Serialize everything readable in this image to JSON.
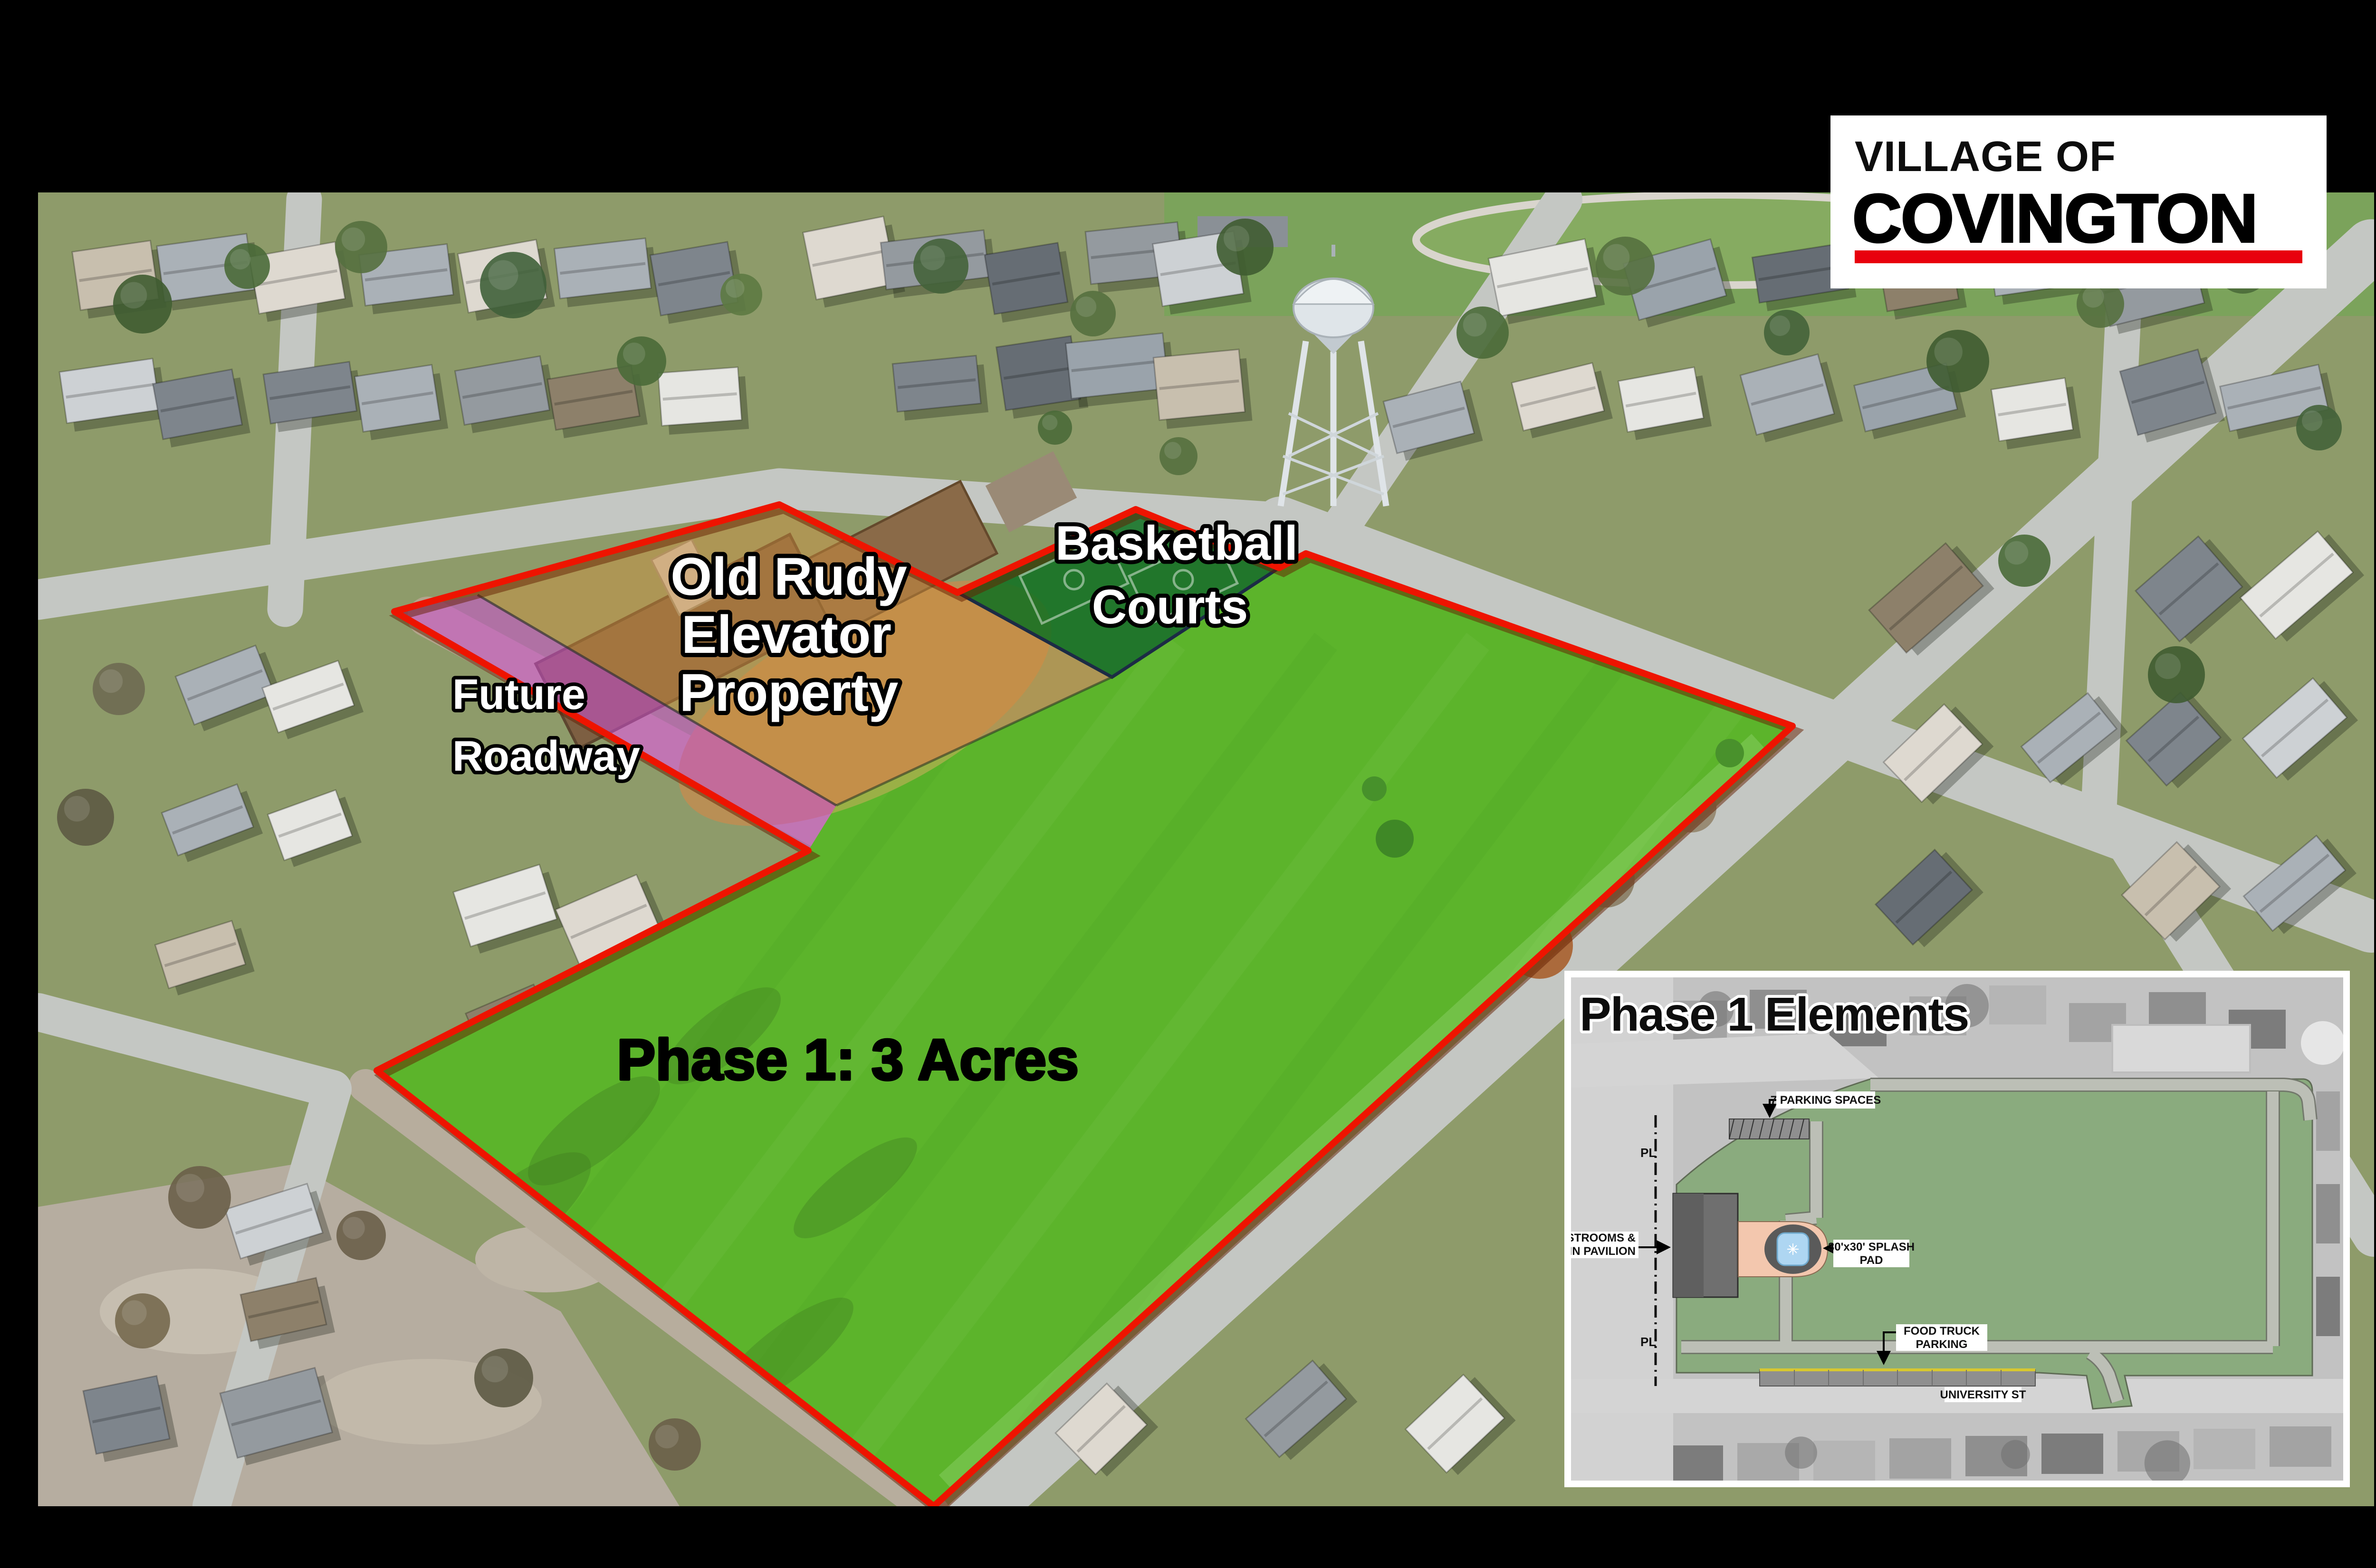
{
  "logo": {
    "line1": "VILLAGE OF",
    "line2": "COVINGTON"
  },
  "map_labels": {
    "old_rudy": {
      "line1": "Old Rudy",
      "line2": "Elevator",
      "line3": "Property"
    },
    "basketball": {
      "line1": "Basketball",
      "line2": "Courts"
    },
    "future_roadway": {
      "line1": "Future",
      "line2": "Roadway"
    },
    "phase1": "Phase 1: 3 Acres"
  },
  "inset": {
    "title": "Phase 1 Elements",
    "labels": {
      "parking": "7 PARKING SPACES",
      "restrooms_line1": "RESTROOMS &",
      "restrooms_line2": "MAIN PAVILION",
      "splash_line1": "30'x30' SPLASH",
      "splash_line2": "PAD",
      "food_line1": "FOOD TRUCK",
      "food_line2": "PARKING",
      "street": "UNIVERSITY ST",
      "property_line": "PL"
    }
  },
  "colors": {
    "brand_red": "#e8000d",
    "boundary_red": "#ee1400",
    "phase1_fill": "#6fdd33",
    "courts_fill": "#0e7020",
    "elevator_fill": "#d2913c",
    "roadway_fill": "#cc4fd4",
    "plan_green": "#8aab7e",
    "plan_path": "#bcbfb6",
    "plaza_salmon": "#f3c7ae",
    "splash_blue": "#aed6f2",
    "stall_gray": "#8f8f8f",
    "stall_yellow": "#d8c830"
  }
}
